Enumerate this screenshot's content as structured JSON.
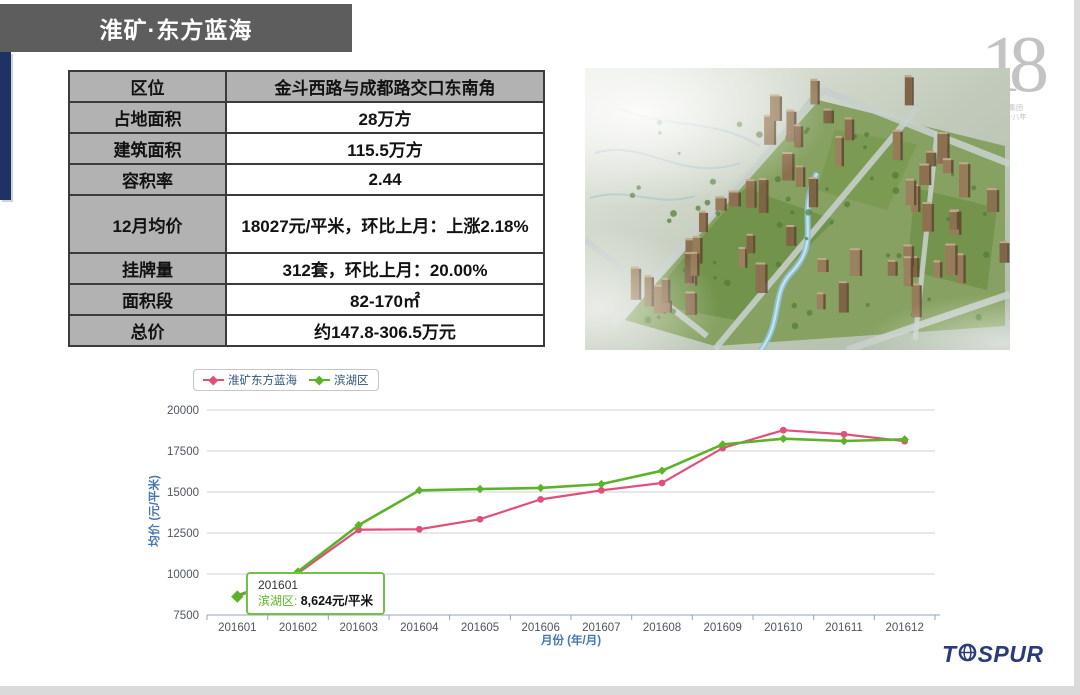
{
  "slide": {
    "title": "淮矿·东方蓝海"
  },
  "info_table": {
    "rows": [
      {
        "label": "区位",
        "value": "金斗西路与成都路交口东南角",
        "header": true
      },
      {
        "label": "占地面积",
        "value": "28万方"
      },
      {
        "label": "建筑面积",
        "value": "115.5万方"
      },
      {
        "label": "容积率",
        "value": "2.44"
      },
      {
        "label": "12月均价",
        "value": "18027元/平米，环比上月：上涨2.18%"
      },
      {
        "label": "挂牌量",
        "value": "312套，环比上月：20.00%"
      },
      {
        "label": "面积段",
        "value": "82-170㎡"
      },
      {
        "label": "总价",
        "value": "约147.8-306.5万元"
      }
    ]
  },
  "chart_data": {
    "type": "line",
    "x": [
      "201601",
      "201602",
      "201603",
      "201604",
      "201605",
      "201606",
      "201607",
      "201608",
      "201609",
      "201610",
      "201611",
      "201612"
    ],
    "series": [
      {
        "name": "淮矿东方蓝海",
        "color": "#e0517a",
        "marker": "circle",
        "values": [
          8700,
          10050,
          12700,
          12730,
          13340,
          14550,
          15100,
          15550,
          17680,
          18770,
          18520,
          18100
        ]
      },
      {
        "name": "滨湖区",
        "color": "#5cb229",
        "marker": "diamond",
        "values": [
          8624,
          10150,
          12980,
          15100,
          15180,
          15250,
          15480,
          16300,
          17900,
          18250,
          18110,
          18210
        ]
      }
    ],
    "ylabel": "均价 (元/平米)",
    "xlabel": "月份 (年/月)",
    "ylim": [
      7500,
      20000
    ],
    "ytick_interval": 2500,
    "grid": true,
    "legend_position": "top-left",
    "tooltip": {
      "title": "201601",
      "series_label": "滨湖区:",
      "value_text": "8,624元/平米"
    }
  },
  "logos": {
    "tospur_t": "T",
    "tospur_rest": "SPUR",
    "badge_number": "18",
    "badge_caption_line1": "同策集团",
    "badge_caption_line2": "地产十八年"
  },
  "colors": {
    "accent_navy": "#1e3263",
    "titlebar_gray": "#5d5d5d",
    "table_gray": "#b2b2b2",
    "axis_title_blue": "#4377ad",
    "tooltip_border_green": "#72c24a"
  }
}
